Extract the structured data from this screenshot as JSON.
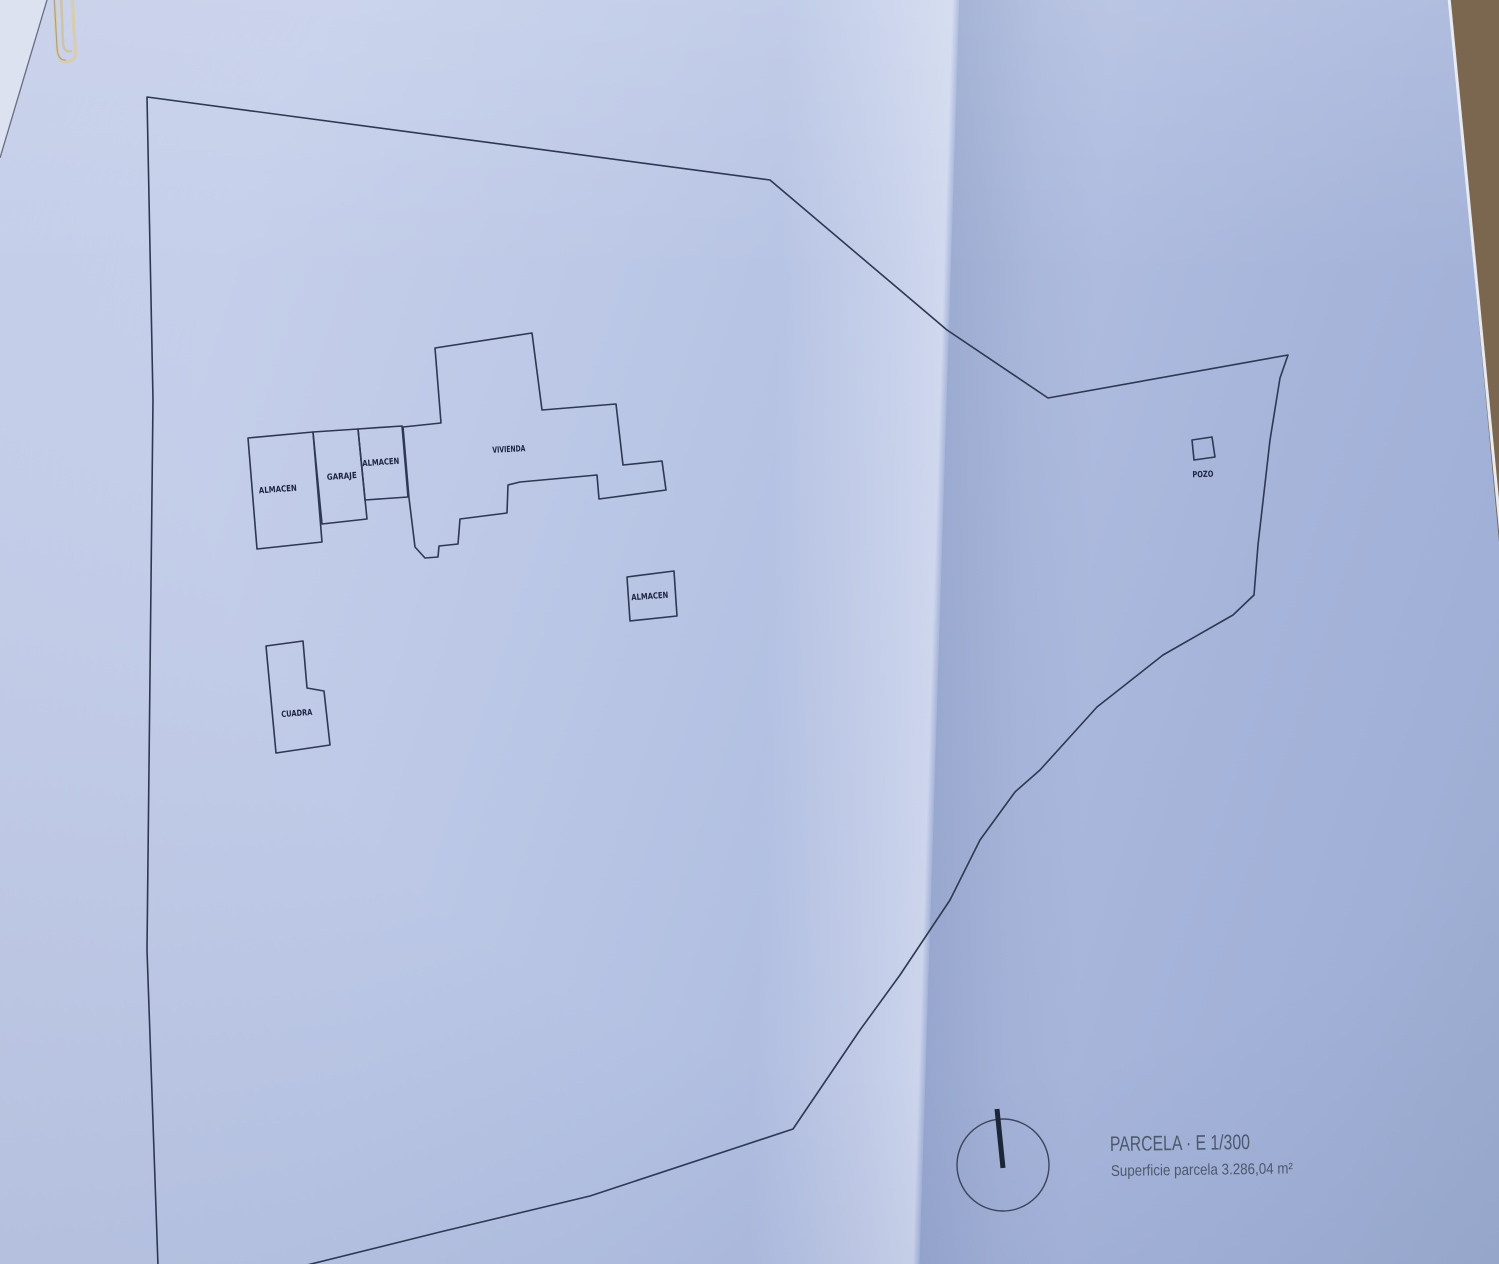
{
  "plan": {
    "buildings": [
      {
        "label": "ALMACEN"
      },
      {
        "label": "GARAJE"
      },
      {
        "label": "ALMACEN"
      },
      {
        "label": "VIVIENDA"
      },
      {
        "label": "ALMACEN"
      },
      {
        "label": "CUADRA"
      }
    ],
    "well_label": "POZO",
    "title": "PARCELA · E 1/300",
    "area_line": "Superficie parcela 3.286,04 m²",
    "colors": {
      "ink": "#2f3852",
      "paper": "#b7c3e2",
      "caption_text": "#4e586c",
      "granite": "#7b6750"
    }
  },
  "photo_objects": {
    "paperclip": "gold paperclip at top-left",
    "countertop": "granite countertop visible past paper edge (top-right)"
  }
}
